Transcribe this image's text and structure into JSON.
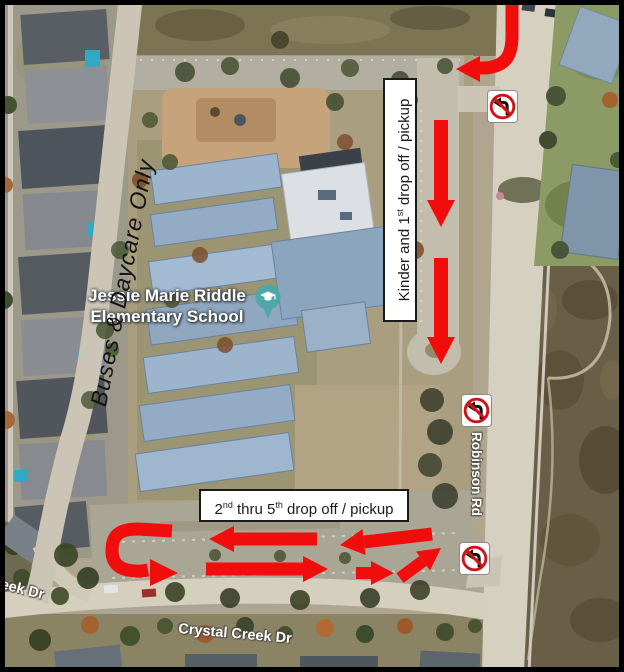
{
  "map": {
    "school": {
      "name_line1": "Jessie Marie Riddle",
      "name_line2": "Elementary School"
    },
    "roads": {
      "robinson": "Robinson Rd",
      "crystal_creek": "Crystal Creek Dr",
      "creek_partial": "eek Dr"
    },
    "routes": {
      "buses_daycare": "Buses & Daycare Only",
      "kinder": {
        "t1": "Kinder and 1",
        "sup1": "st",
        "t2": " drop off / pickup"
      },
      "grades": {
        "t1": "2",
        "sup1": "nd",
        "t2": " thru 5",
        "sup2": "th",
        "t3": " drop off / pickup"
      }
    },
    "signs": {
      "type": "no-left-turn",
      "count": 3
    },
    "colors": {
      "arrow_red": "#f20d0d",
      "sign_red": "#cf1418",
      "pin_teal": "#4fa8a8",
      "label_bg": "#ffffff",
      "label_border": "#1a1a1a"
    }
  }
}
